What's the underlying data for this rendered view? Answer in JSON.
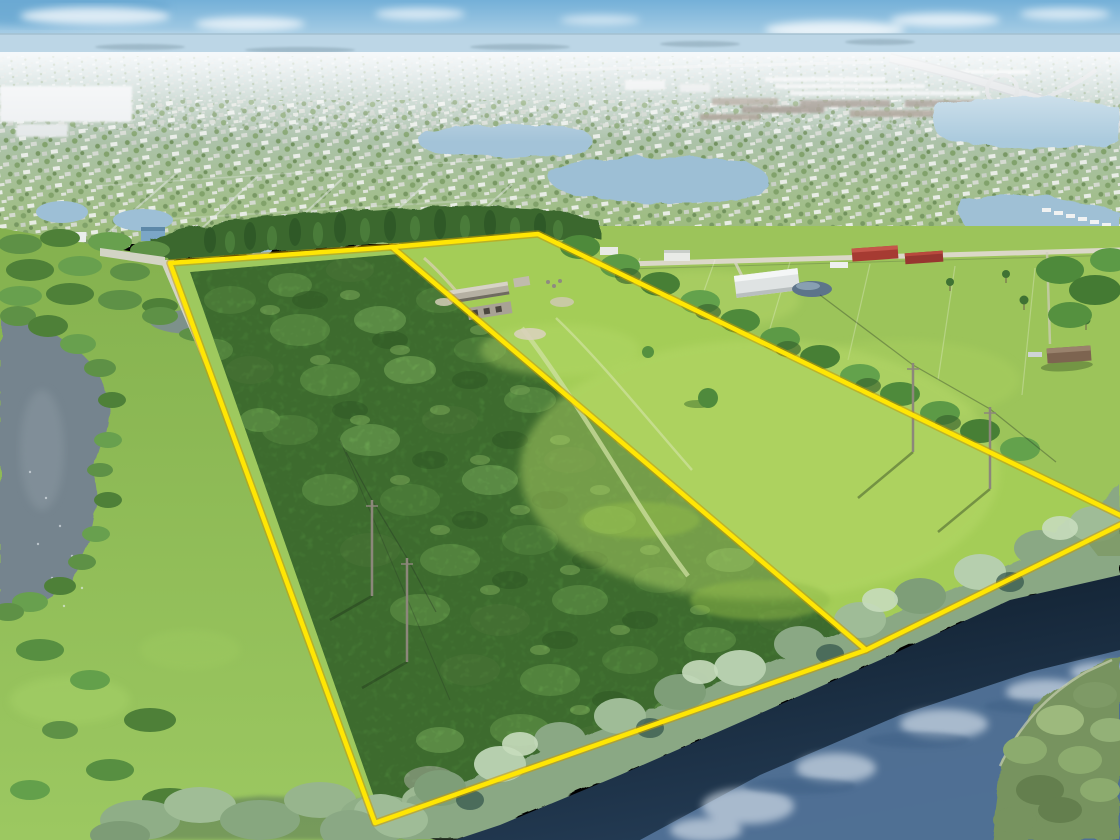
{
  "scene": {
    "type": "aerial-drone-photograph",
    "subject": "vacant land parcels outlined in yellow",
    "foreground": "wooded parcel and cleared pasture parcel split by a surveyed divider line, dirt road on west edge",
    "background": "suburban neighborhoods with lakes, highway interchange, rural homesteads, hazy lagoon horizon",
    "south_edge": "dark canal water reflecting sky and clouds with vegetated island"
  },
  "overlay": {
    "boundary_color": "#ffe604",
    "boundary_edge_color": "#c79a00",
    "width": 4.5,
    "edge_width": 7.5,
    "outer_points": "170,263 392,247 538,234 1130,520 866,650 375,823",
    "divider_points": "392,247 866,650"
  },
  "palette": {
    "sky_top": "#74b0d8",
    "sky_mid": "#cfe4ef",
    "sky_bottom": "#eef5f8",
    "lagoon": "#bcd6e6",
    "suburb_top": "#c6d8df",
    "suburb_mid": "#aec3ae",
    "suburb_bottom": "#9abb77",
    "lake_blue": "#a3c3d8",
    "pine_green": "#3a672f",
    "rural_grass": "#9cc45a",
    "pasture_green": "#a4cd57",
    "woods_green": "#4f8a3c",
    "parcel_margin_green": "#9ec95e",
    "meadow_top": "#84b14e",
    "meadow_bottom": "#9cc861",
    "pond_gray": "#75848e",
    "road_tan": "#d3d4c5",
    "bank_trees": "#8aa884",
    "canal_top": "#0c1926",
    "canal_bottom": "#243c55",
    "reflection_blue": "#54769b",
    "cloud_reflection": "#d8e2ec",
    "island_olive": "#77935f",
    "barn_red": "#a63b32",
    "barn_white": "#dfe3e3",
    "pavilion_brown": "#7d6450",
    "house_blue": "#7ba6c6"
  }
}
